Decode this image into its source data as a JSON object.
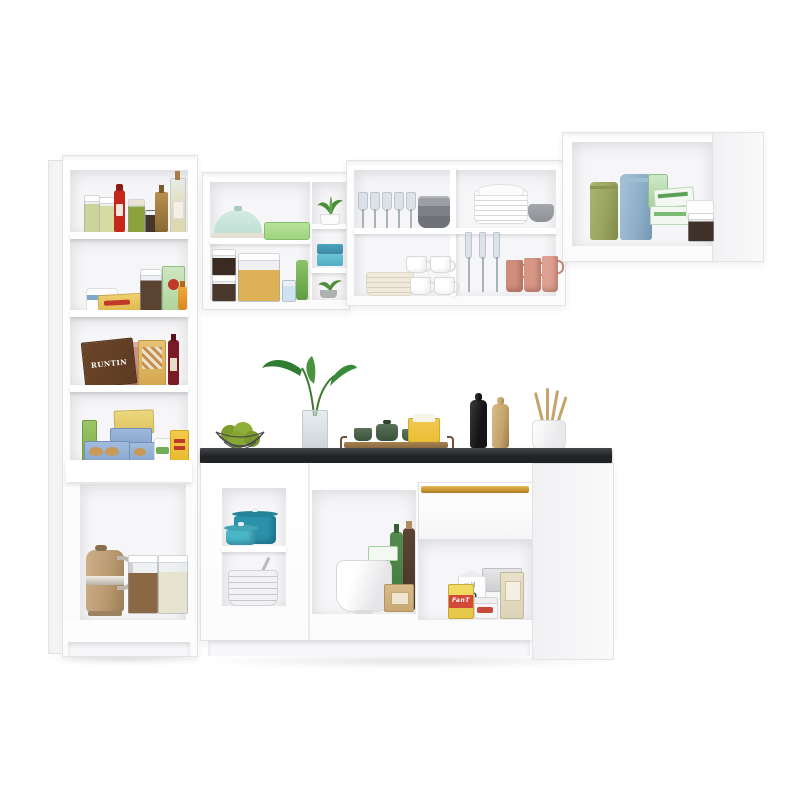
{
  "scene": {
    "title": "White L-shaped modular kitchen cabinet set with open shelves, black countertop and pantry accessories",
    "background": "#ffffff",
    "modules": {
      "pantry": {
        "name": "tall pantry cabinet with open shelves",
        "shelf1": [
          "two jars of pickled vegetables",
          "ketchup bottle",
          "jar of green olives",
          "small preserve jar",
          "amber oil bottle",
          "tall olive-oil bottle"
        ],
        "shelf2": [
          "round butter tub",
          "yellow cracker box",
          "glass canister with dried goods",
          "green tea box",
          "honey bottle"
        ],
        "shelf3": [
          "chocolate box",
          "stacked terracotta bowls",
          "cereal box",
          "red vinegar bottle"
        ],
        "shelf4": [
          "green carton",
          "oat box",
          "blue biscuit boxes",
          "white tub with green label",
          "yellow snack box"
        ],
        "niche": [
          "champagne electric kettle",
          "canister with coffee",
          "canister with flour"
        ]
      },
      "corner_wall_cabinet": {
        "name": "corner wall cabinet",
        "top_shelf": [
          "mint cake dome",
          "green storage container"
        ],
        "bottom_shelf": [
          "stacked jars with dried berries",
          "cereal canister",
          "small jar",
          "green can"
        ],
        "side_column": [
          "potted succulent",
          "blue food containers",
          "potted succulent"
        ]
      },
      "mid_wall_cabinet": {
        "name": "double wall cabinet with dishware",
        "top_left": [
          "wine glasses",
          "stack of gray bowls"
        ],
        "top_right": [
          "stack of white dishes",
          "gray bowl"
        ],
        "bottom_left": [
          "stack of cream plates",
          "four white cups"
        ],
        "bottom_right": [
          "champagne flutes",
          "three pink mugs"
        ]
      },
      "right_wall_cabinet": {
        "name": "right wall cabinet",
        "items": [
          "green canister",
          "blue canister",
          "green pouch",
          "tea boxes",
          "white box",
          "jar of preserves"
        ]
      },
      "countertop": {
        "name": "black countertop",
        "items": [
          "wire basket with green apples",
          "glass vase with leafy plant",
          "wooden serving tray with green cups",
          "yellow napkin box",
          "black pepper mill",
          "wooden pepper mill",
          "white crock with wooden utensils"
        ]
      },
      "base_corner": {
        "name": "corner base cabinet niche",
        "top": [
          "teal dutch oven",
          "turquoise saucepan"
        ],
        "bottom": [
          "stacked bowls with ladle"
        ]
      },
      "base_middle": {
        "name": "middle base cabinet niche",
        "items": [
          "white mixing bowl",
          "green glass bottle",
          "dark corked bottle",
          "small box",
          "kraft paper bag"
        ]
      },
      "base_right": {
        "name": "base cabinet with drawer",
        "drawer": "drawer with gold handle",
        "items": [
          "milk carton",
          "foil box",
          "juice box",
          "jam jar",
          "tall beige box"
        ]
      }
    }
  },
  "labels": {
    "chocolate_box": "RUNTIN",
    "juice_box": "FanT",
    "milk_carton": "mil",
    "white_box": "20"
  },
  "colors": {
    "cab_edge": "#e3e3e6",
    "interior": "#f6f6f8",
    "counter_dark": "#212325",
    "gold": "#c9962f",
    "teal_dark": "#1f7f96",
    "teal_mid": "#2a93ab",
    "teal_light": "#49b7c8",
    "kettle": "#b9986f",
    "apple": "#86a832",
    "leaf": "#2f7d33",
    "mug_pink": "#d08d7c",
    "gray_dish": "#8b8e92",
    "cream": "#efeadb",
    "can_green": "#98a55e",
    "can_blue": "#8fb0c9",
    "mint": "#bfe0d6",
    "tray_green": "#9fd47f",
    "wood": "#8a6a42",
    "wood_light": "#c4a36c",
    "ketchup": "#c5271b",
    "olive": "#8aa33c",
    "wine": "#7a1a25",
    "yellow": "#e9bc2f",
    "tea_green": "#59a357",
    "choc": "#5d3a22",
    "terracotta": "#c08a76",
    "blue_box": "#8aa8d0",
    "milk_red": "#d24a3a",
    "kraft": "#c9a876",
    "beige": "#ddd3b8"
  }
}
